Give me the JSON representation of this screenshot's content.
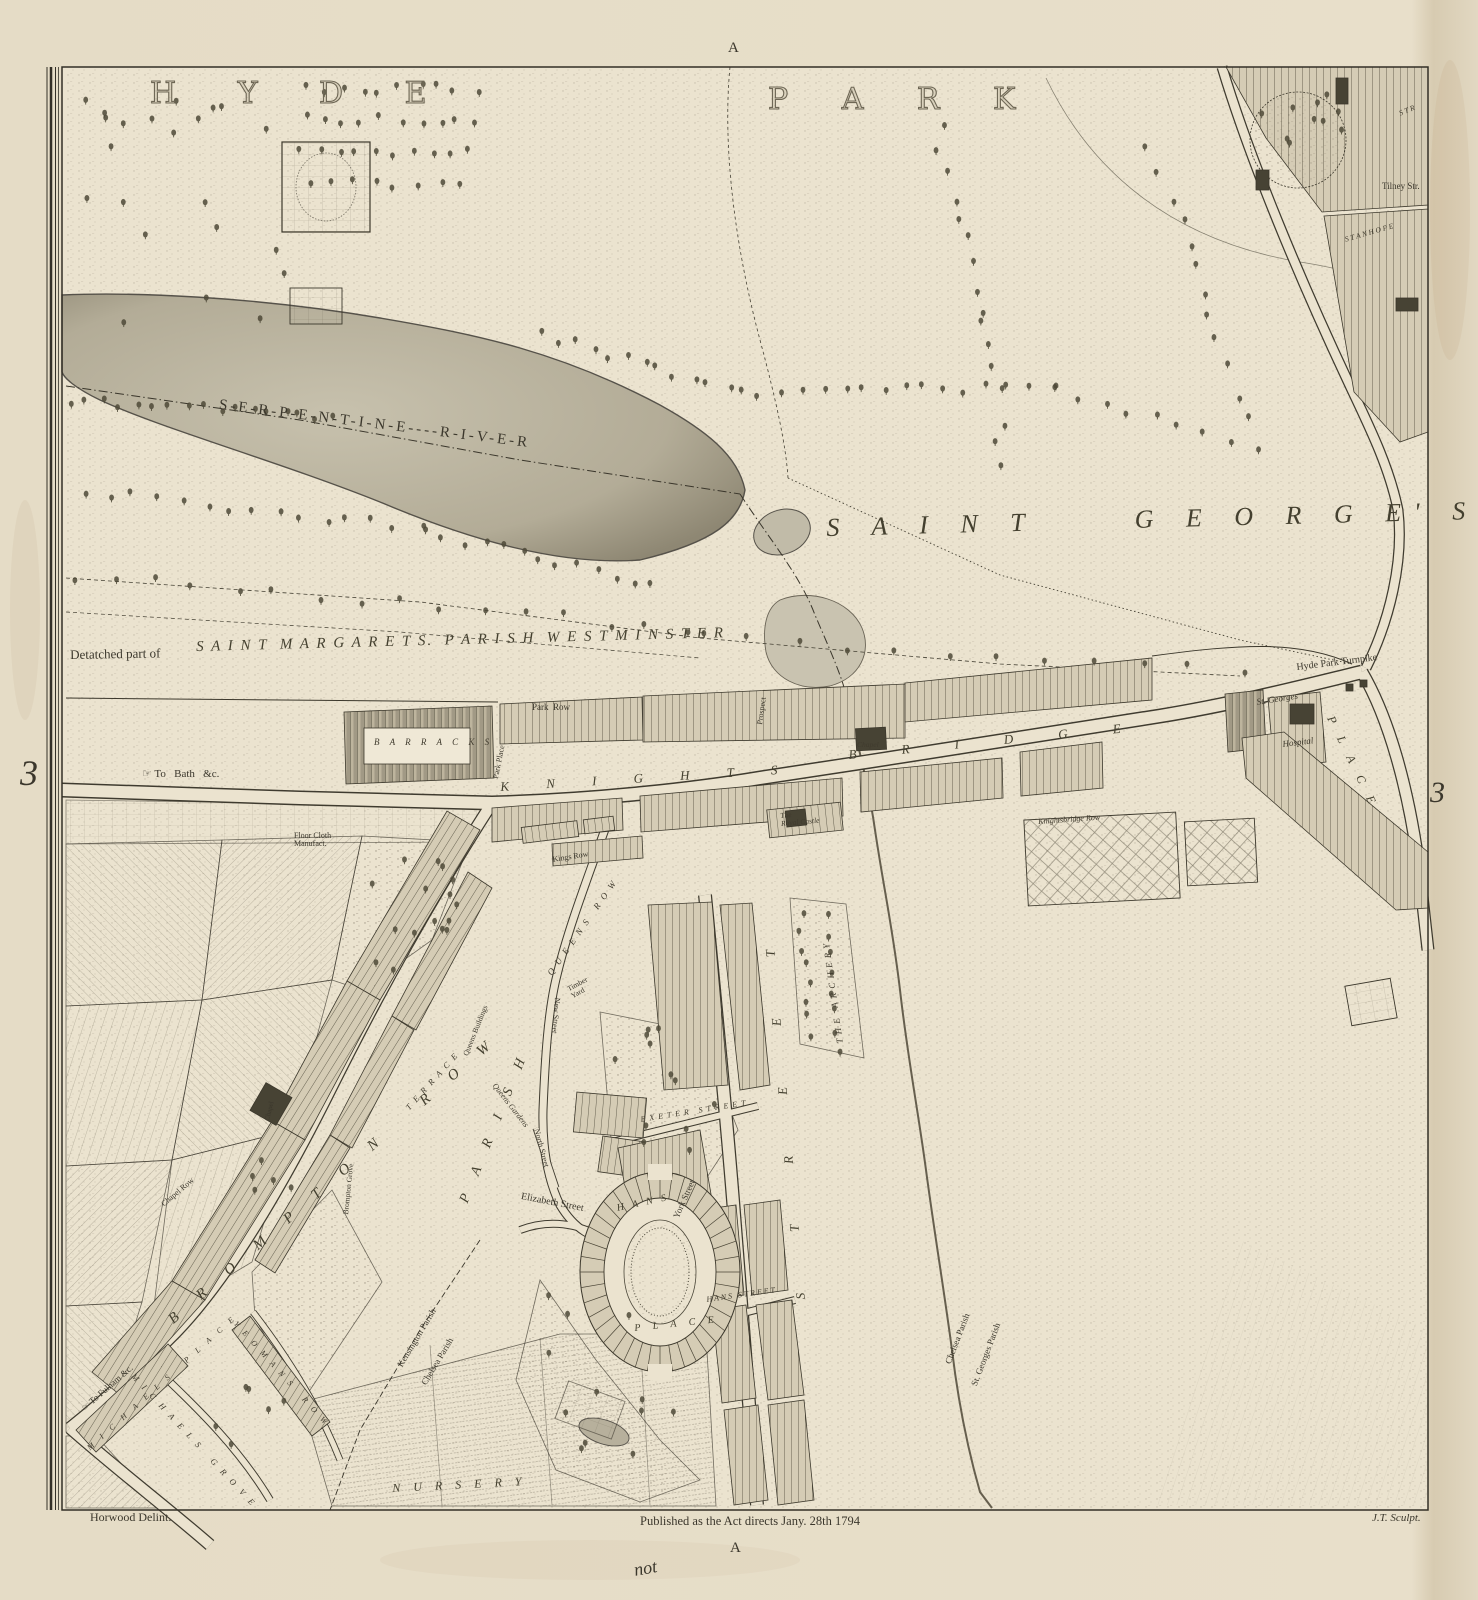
{
  "sheet": {
    "grid_letter_top": "A",
    "grid_letter_bottom": "A",
    "grid_number_left": "3",
    "grid_number_right": "3"
  },
  "imprint": {
    "surveyor": "Horwood Delint.",
    "publication": "Published as the Act directs Jany. 28th 1794",
    "engraver": "J.T. Sculpt.",
    "manuscript_note": "not"
  },
  "colors": {
    "paper": "#ebe3cf",
    "margin_paper": "#e6ddc8",
    "ink": "#3b372c",
    "water": "#b7b09c",
    "annotation_ink": "#a25a3c"
  },
  "labels": [
    {
      "id": "hyde",
      "text": "H Y D E",
      "x": 150,
      "y": 78,
      "size": 30,
      "ls": 26,
      "cls": "outline"
    },
    {
      "id": "park",
      "text": "P A R K",
      "x": 768,
      "y": 84,
      "size": 30,
      "ls": 22,
      "cls": "outline"
    },
    {
      "id": "serpentine-river",
      "text": "S-E-R-P-E-N-T-I-N-E----R-I-V-E-R",
      "x": 220,
      "y": 398,
      "size": 15,
      "ls": 3,
      "rot": 7,
      "cls": "roman"
    },
    {
      "id": "saint-georges",
      "text": "S A I N T     G E O R G E' S",
      "x": 826,
      "y": 514,
      "size": 26,
      "ls": 13,
      "rot": -1.5,
      "cls": "bigitalic"
    },
    {
      "id": "detached-part",
      "text": "Detatched part of",
      "x": 70,
      "y": 648,
      "size": 13,
      "rot": -1,
      "cls": "roman"
    },
    {
      "id": "saint-margarets",
      "text": "S A I N T  M A R G A R E T S.  P A R I S H  W E S T M I N S T E R",
      "x": 196,
      "y": 640,
      "size": 15,
      "ls": 2,
      "rot": -1.5,
      "cls": "bigitalic"
    },
    {
      "id": "knights",
      "text": "K N I G H T S",
      "x": 500,
      "y": 780,
      "size": 13,
      "ls": 17,
      "rot": -3.5,
      "cls": "bigitalic"
    },
    {
      "id": "bridge",
      "text": "B R I D G E",
      "x": 848,
      "y": 748,
      "size": 13,
      "ls": 21,
      "rot": -5.5,
      "cls": "bigitalic"
    },
    {
      "id": "hyde-park-turnpike",
      "text": "Hyde Park Turnpike",
      "x": 1296,
      "y": 663,
      "size": 10,
      "rot": -7,
      "cls": "roman"
    },
    {
      "id": "to-bath",
      "text": "☞ To   Bath   &c.",
      "x": 142,
      "y": 769,
      "size": 11,
      "cls": "roman"
    },
    {
      "id": "park-row",
      "text": "Park  Row",
      "x": 532,
      "y": 703,
      "size": 9,
      "cls": "roman"
    },
    {
      "id": "park-place",
      "text": "Park Place",
      "x": 492,
      "y": 778,
      "size": 8,
      "rot": -79,
      "cls": "roman"
    },
    {
      "id": "prospect",
      "text": "Prospect",
      "x": 756,
      "y": 724,
      "size": 8,
      "rot": -82,
      "cls": "roman"
    },
    {
      "id": "barracks",
      "text": "B A R R A C K S",
      "x": 374,
      "y": 738,
      "size": 9,
      "ls": 4,
      "cls": "italic"
    },
    {
      "id": "chapel-knightsbridge",
      "text": "Chapel",
      "x": 857,
      "y": 741,
      "size": 7.5,
      "cls": "italic"
    },
    {
      "id": "kings-row",
      "text": "Kings Row",
      "x": 552,
      "y": 856,
      "size": 8,
      "rot": -9,
      "cls": "roman"
    },
    {
      "id": "royal-castle",
      "text": "The\nRoyal Castle",
      "x": 780,
      "y": 812,
      "size": 7.5,
      "rot": -5,
      "cls": "italic"
    },
    {
      "id": "floor-cloth",
      "text": "Floor Cloth\nManufact.",
      "x": 294,
      "y": 832,
      "size": 8,
      "cls": "roman"
    },
    {
      "id": "knightsbridge-row",
      "text": "Knightsbridge Row",
      "x": 1038,
      "y": 818,
      "size": 8,
      "rot": -4,
      "cls": "italic"
    },
    {
      "id": "st-georges-label",
      "text": "St. Georges",
      "x": 1256,
      "y": 698,
      "size": 9,
      "rot": -9,
      "cls": "italic"
    },
    {
      "id": "hospital",
      "text": "Hospital",
      "x": 1282,
      "y": 740,
      "size": 9,
      "rot": -7,
      "cls": "italic"
    },
    {
      "id": "place-grosvenor",
      "text": "P L A C E",
      "x": 1336,
      "y": 714,
      "size": 12,
      "ls": 6,
      "rot": 64,
      "cls": "bigitalic"
    },
    {
      "id": "tilney-str",
      "text": "Tilney Str.",
      "x": 1382,
      "y": 182,
      "size": 9,
      "cls": "roman"
    },
    {
      "id": "stanhope",
      "text": "S T A N H O P E",
      "x": 1344,
      "y": 236,
      "size": 7.5,
      "rot": -16,
      "cls": "italic"
    },
    {
      "id": "str-fragment",
      "text": "S T R",
      "x": 1398,
      "y": 110,
      "size": 7.5,
      "rot": -22,
      "cls": "italic"
    },
    {
      "id": "the-archery",
      "text": "T H E   A R C H E R Y",
      "x": 836,
      "y": 1044,
      "size": 9,
      "ls": 1,
      "rot": -98,
      "cls": "italic"
    },
    {
      "id": "queens-row",
      "text": "Q U E E N S   R O W",
      "x": 546,
      "y": 972,
      "size": 9,
      "ls": 2,
      "rot": -55,
      "cls": "italic"
    },
    {
      "id": "new-street",
      "text": "New Street",
      "x": 561,
      "y": 998,
      "size": 8,
      "rot": 95,
      "cls": "roman"
    },
    {
      "id": "north-street",
      "text": "North Street",
      "x": 540,
      "y": 1128,
      "size": 8,
      "rot": 75,
      "cls": "roman"
    },
    {
      "id": "exeter-street",
      "text": "E X E T E R   S T R E E T",
      "x": 640,
      "y": 1116,
      "size": 8,
      "ls": 1,
      "rot": -9,
      "cls": "italic"
    },
    {
      "id": "elizabeth-street",
      "text": "Elizabeth Street",
      "x": 522,
      "y": 1192,
      "size": 10,
      "rot": 11,
      "cls": "roman"
    },
    {
      "id": "york-street",
      "text": "York Street",
      "x": 672,
      "y": 1216,
      "size": 9,
      "rot": -66,
      "cls": "roman"
    },
    {
      "id": "hans",
      "text": "H A N S",
      "x": 616,
      "y": 1204,
      "size": 10,
      "ls": 3,
      "rot": -12,
      "cls": "bigitalic"
    },
    {
      "id": "place-hans",
      "text": "P L A C E",
      "x": 634,
      "y": 1324,
      "size": 10,
      "ls": 5,
      "rot": -6,
      "cls": "bigitalic"
    },
    {
      "id": "hans-street",
      "text": "H A N S   S T R E E T",
      "x": 706,
      "y": 1296,
      "size": 8,
      "rot": -8,
      "cls": "italic"
    },
    {
      "id": "street-sloane",
      "text": "S T R E E T",
      "x": 794,
      "y": 1300,
      "size": 13,
      "ls": 29,
      "rot": -95,
      "cls": "bigitalic"
    },
    {
      "id": "timber-yard",
      "text": "Timber\nYard",
      "x": 566,
      "y": 986,
      "size": 7.5,
      "rot": -28,
      "cls": "roman"
    },
    {
      "id": "queens-buildings",
      "text": "Queens Buildings",
      "x": 462,
      "y": 1054,
      "size": 7.5,
      "rot": -68,
      "cls": "roman"
    },
    {
      "id": "terrace",
      "text": "T E R R A C E",
      "x": 404,
      "y": 1106,
      "size": 8.5,
      "ls": 2,
      "rot": -48,
      "cls": "italic"
    },
    {
      "id": "queens-gardens",
      "text": "Queens Gardens",
      "x": 497,
      "y": 1082,
      "size": 8,
      "rot": 52,
      "cls": "italic"
    },
    {
      "id": "brompton-grove",
      "text": "Brompton Grove",
      "x": 342,
      "y": 1214,
      "size": 7.5,
      "rot": -84,
      "cls": "roman"
    },
    {
      "id": "chapel-row",
      "text": "Chapel Row",
      "x": 160,
      "y": 1202,
      "size": 8,
      "rot": -40,
      "cls": "roman"
    },
    {
      "id": "chapel-brompton",
      "text": "Chapel",
      "x": 264,
      "y": 1120,
      "size": 7,
      "rot": -76,
      "cls": "roman"
    },
    {
      "id": "brompton-row",
      "text": "B R O M P T O N   R O W",
      "x": 166,
      "y": 1316,
      "size": 15,
      "ls": 12,
      "rot": -41,
      "cls": "bigitalic"
    },
    {
      "id": "parish",
      "text": "P A R I S H",
      "x": 458,
      "y": 1200,
      "size": 14,
      "ls": 9,
      "rot": -68,
      "cls": "bigitalic"
    },
    {
      "id": "kensington-parish",
      "text": "Kensington Parish",
      "x": 396,
      "y": 1364,
      "size": 9,
      "rot": -59,
      "cls": "roman"
    },
    {
      "id": "chelsea-parish-west",
      "text": "Chelsea Parish",
      "x": 420,
      "y": 1382,
      "size": 9,
      "rot": -59,
      "cls": "roman"
    },
    {
      "id": "michaels-place",
      "text": "M I C H A E L S   P L A C E",
      "x": 86,
      "y": 1446,
      "size": 8,
      "ls": 4,
      "rot": -42,
      "cls": "italic"
    },
    {
      "id": "michaels-grove",
      "text": "M I C H A E L S   G R O V E",
      "x": 136,
      "y": 1372,
      "size": 8.5,
      "ls": 3,
      "rot": 47,
      "cls": "italic"
    },
    {
      "id": "yeomans-row",
      "text": "Y E O M A N S   R O W",
      "x": 238,
      "y": 1320,
      "size": 8,
      "ls": 3,
      "rot": 48,
      "cls": "italic"
    },
    {
      "id": "to-fulham",
      "text": "☞ To Fulham &c.",
      "x": 80,
      "y": 1406,
      "size": 9,
      "rot": -41,
      "cls": "roman"
    },
    {
      "id": "nursery",
      "text": "N U R S E R Y",
      "x": 392,
      "y": 1482,
      "size": 12,
      "ls": 5,
      "rot": -3,
      "cls": "bigitalic"
    },
    {
      "id": "chelsea-parish-east",
      "text": "Chelsea Parish",
      "x": 944,
      "y": 1362,
      "size": 9,
      "rot": -69,
      "cls": "roman"
    },
    {
      "id": "st-georges-parish",
      "text": "St. Georges Parish",
      "x": 970,
      "y": 1384,
      "size": 9,
      "rot": -69,
      "cls": "roman"
    }
  ]
}
